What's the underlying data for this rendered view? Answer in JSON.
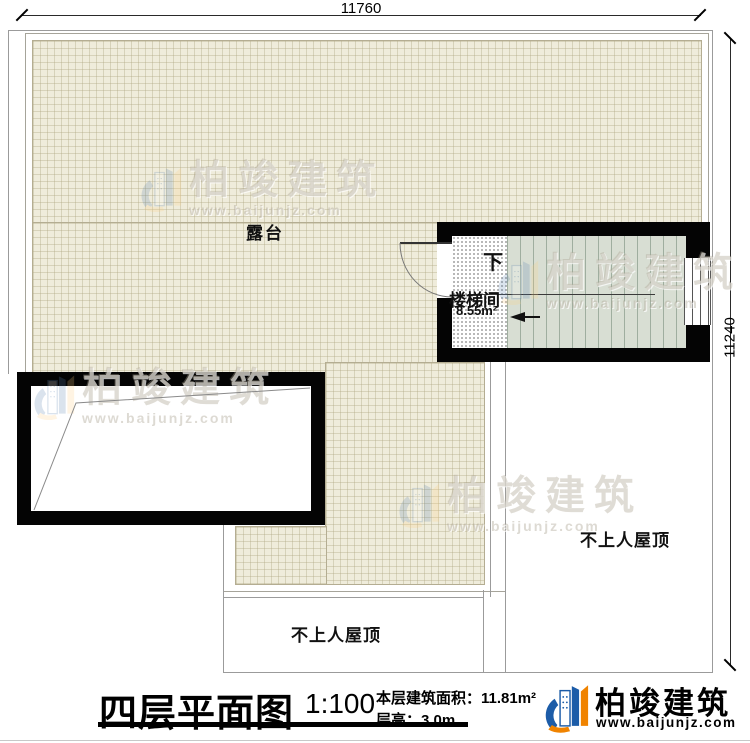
{
  "dims": {
    "top": "11760",
    "right": "11240"
  },
  "rooms": {
    "terrace": "露台",
    "stair_name": "楼梯间",
    "stair_area": "8.55m²",
    "down": "下",
    "roof_bottom": "不上人屋顶",
    "roof_right": "不上人屋顶"
  },
  "titleblock": {
    "title": "四层平面图",
    "scale": "1:100",
    "area": "本层建筑面积：11.81m²",
    "floor_height": "层高：3.0m"
  },
  "brand": {
    "name": "柏竣建筑",
    "url": "www.baijunjz.com"
  },
  "watermark": {
    "name": "柏竣建筑",
    "url": "www.baijunjz.com"
  },
  "colors": {
    "wall": "#040404",
    "terrace_fill": "#efecdb",
    "stair_fill": "#d8ded3",
    "brand_blue": "#1c5ca8",
    "brand_orange": "#f08300"
  }
}
